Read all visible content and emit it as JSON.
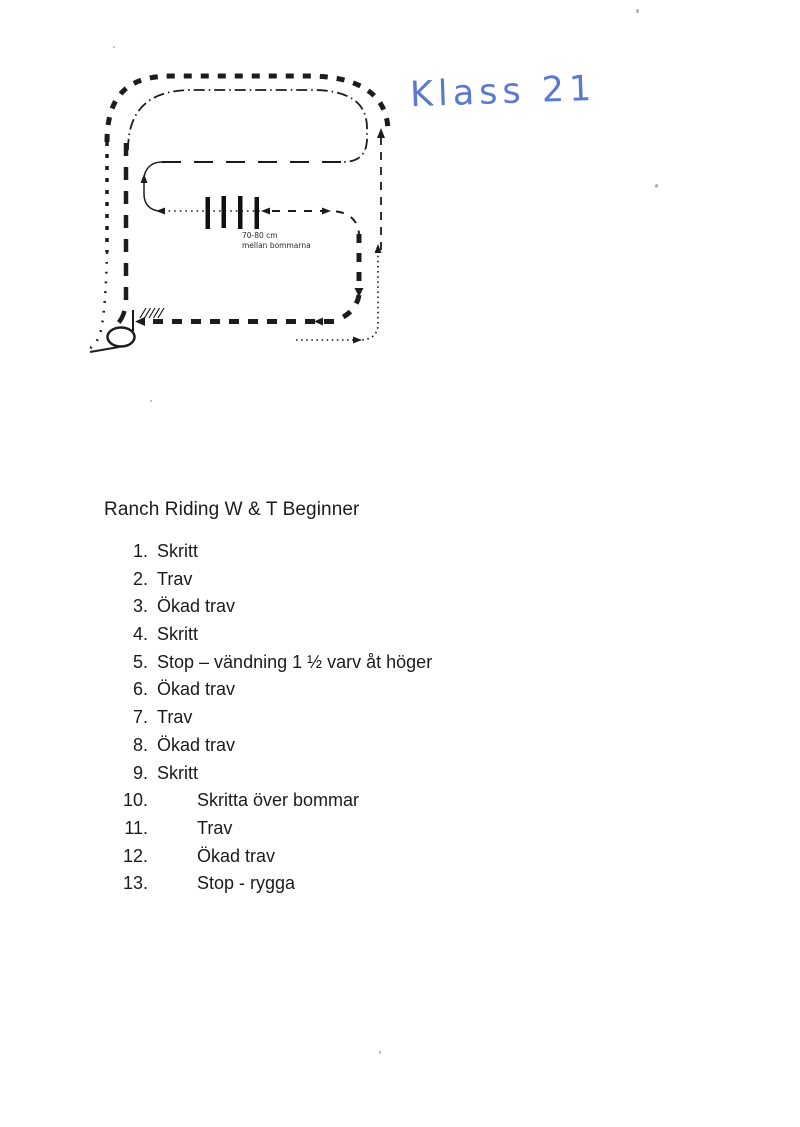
{
  "diagram": {
    "handwritten_label": "Klass 21",
    "handwriting_color": "#5b79cf",
    "ink_color": "#1c1c1c",
    "poles_label_line1": "70-80 cm",
    "poles_label_line2": "mellan bommarna"
  },
  "pattern": {
    "title": "Ranch Riding W & T Beginner",
    "items": [
      {
        "num": "1.",
        "label": "Skritt",
        "wide": false
      },
      {
        "num": "2.",
        "label": "Trav",
        "wide": false
      },
      {
        "num": "3.",
        "label": "Ökad trav",
        "wide": false
      },
      {
        "num": "4.",
        "label": "Skritt",
        "wide": false
      },
      {
        "num": "5.",
        "label": "Stop – vändning 1 ½ varv åt höger",
        "wide": false
      },
      {
        "num": "6.",
        "label": "Ökad trav",
        "wide": false
      },
      {
        "num": "7.",
        "label": "Trav",
        "wide": false
      },
      {
        "num": "8.",
        "label": "Ökad trav",
        "wide": false
      },
      {
        "num": "9.",
        "label": "Skritt",
        "wide": false
      },
      {
        "num": "10.",
        "label": "Skritta över bommar",
        "wide": true
      },
      {
        "num": "11.",
        "label": "Trav",
        "wide": true
      },
      {
        "num": "12.",
        "label": "Ökad trav",
        "wide": true
      },
      {
        "num": "13.",
        "label": "Stop - rygga",
        "wide": true
      }
    ]
  }
}
